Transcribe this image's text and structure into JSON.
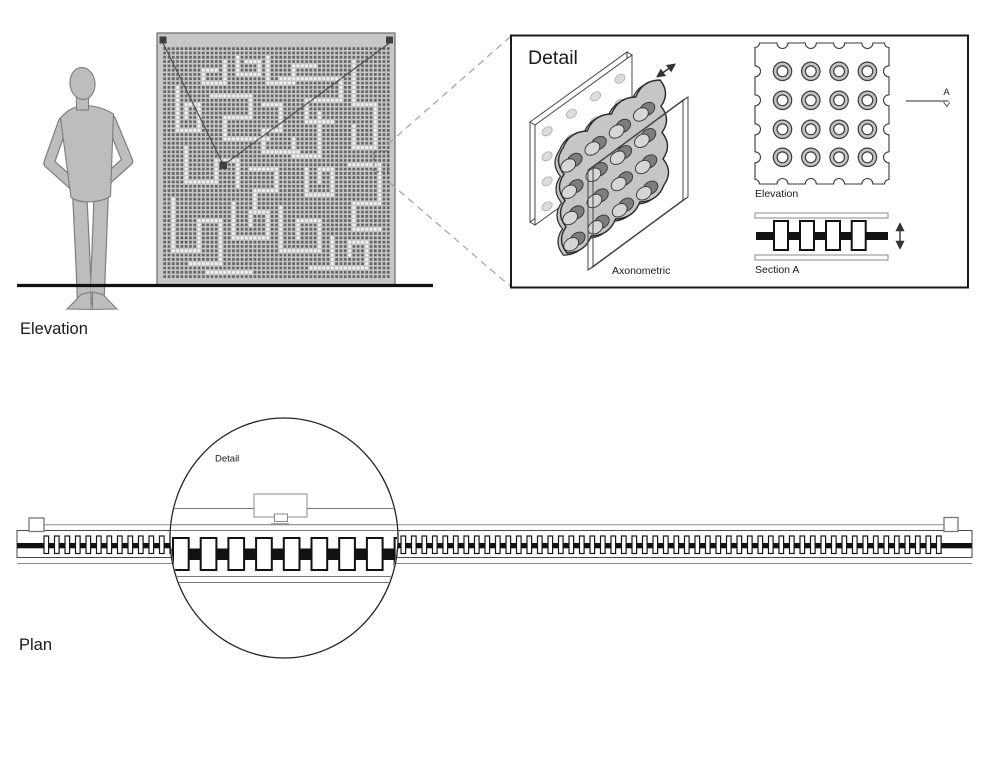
{
  "labels": {
    "elevation_view": "Elevation",
    "plan_view": "Plan",
    "detail_box_title": "Detail",
    "axonometric": "Axonometric",
    "detail_elevation": "Elevation",
    "section_a": "Section A",
    "section_marker": "A",
    "plan_detail_callout": "Detail"
  },
  "colors": {
    "ink": "#1a1a1a",
    "line_mid": "#555555",
    "line_light": "#8a8a8a",
    "dash": "#a2a2a2",
    "panel_bg": "#c7c7c7",
    "panel_dot": "#646464",
    "panel_dot_lit": "#f2f2f2",
    "silhouette": "#bdbdbd",
    "silhouette_outline": "#7d7d7d",
    "plate": "#c6c6c6",
    "peg_face": "#d6d6d6",
    "peg_dark": "#7d7d7d",
    "slab_hole": "#dcdcdc"
  },
  "panel_pattern": {
    "cols": 53,
    "rows": 54,
    "pitch": 4.3,
    "dot": 2.7,
    "origin": [
      162.5,
      46.5
    ],
    "lit_paths": [
      [
        [
          14,
          3
        ],
        [
          14,
          8
        ],
        [
          9,
          8
        ],
        [
          9,
          5
        ],
        [
          12,
          5
        ]
      ],
      [
        [
          17,
          2
        ],
        [
          17,
          6
        ],
        [
          22,
          6
        ],
        [
          22,
          3
        ],
        [
          19,
          3
        ]
      ],
      [
        [
          24,
          2
        ],
        [
          24,
          8
        ],
        [
          30,
          8
        ],
        [
          30,
          4
        ],
        [
          35,
          4
        ]
      ],
      [
        [
          3,
          9
        ],
        [
          3,
          19
        ],
        [
          8,
          19
        ],
        [
          8,
          13
        ],
        [
          5,
          13
        ],
        [
          5,
          16
        ]
      ],
      [
        [
          11,
          11
        ],
        [
          20,
          11
        ],
        [
          20,
          16
        ],
        [
          14,
          16
        ],
        [
          14,
          21
        ],
        [
          24,
          21
        ]
      ],
      [
        [
          27,
          7
        ],
        [
          41,
          7
        ],
        [
          41,
          12
        ],
        [
          33,
          12
        ],
        [
          33,
          17
        ],
        [
          39,
          17
        ]
      ],
      [
        [
          44,
          3
        ],
        [
          44,
          13
        ],
        [
          49,
          13
        ],
        [
          49,
          23
        ],
        [
          44,
          23
        ],
        [
          44,
          18
        ]
      ],
      [
        [
          23,
          13
        ],
        [
          27,
          13
        ],
        [
          27,
          19
        ],
        [
          23,
          19
        ],
        [
          23,
          24
        ],
        [
          31,
          24
        ]
      ],
      [
        [
          36,
          15
        ],
        [
          36,
          25
        ],
        [
          30,
          25
        ],
        [
          30,
          21
        ]
      ],
      [
        [
          5,
          23
        ],
        [
          5,
          31
        ],
        [
          12,
          31
        ],
        [
          12,
          26
        ],
        [
          17,
          26
        ],
        [
          17,
          32
        ]
      ],
      [
        [
          20,
          28
        ],
        [
          26,
          28
        ],
        [
          26,
          33
        ],
        [
          21,
          33
        ],
        [
          21,
          37
        ]
      ],
      [
        [
          33,
          28
        ],
        [
          33,
          34
        ],
        [
          39,
          34
        ],
        [
          39,
          28
        ],
        [
          36,
          28
        ],
        [
          36,
          31
        ]
      ],
      [
        [
          43,
          27
        ],
        [
          50,
          27
        ],
        [
          50,
          36
        ],
        [
          44,
          36
        ],
        [
          44,
          42
        ],
        [
          50,
          42
        ]
      ],
      [
        [
          2,
          35
        ],
        [
          2,
          47
        ],
        [
          8,
          47
        ],
        [
          8,
          40
        ],
        [
          13,
          40
        ],
        [
          13,
          50
        ],
        [
          6,
          50
        ]
      ],
      [
        [
          16,
          36
        ],
        [
          16,
          44
        ],
        [
          24,
          44
        ],
        [
          24,
          38
        ],
        [
          20,
          38
        ],
        [
          20,
          41
        ]
      ],
      [
        [
          27,
          37
        ],
        [
          27,
          47
        ],
        [
          36,
          47
        ],
        [
          36,
          40
        ],
        [
          31,
          40
        ],
        [
          31,
          44
        ]
      ],
      [
        [
          39,
          44
        ],
        [
          39,
          51
        ],
        [
          47,
          51
        ],
        [
          47,
          45
        ],
        [
          43,
          45
        ],
        [
          43,
          48
        ]
      ],
      [
        [
          10,
          52
        ],
        [
          20,
          52
        ]
      ],
      [
        [
          34,
          51
        ],
        [
          42,
          51
        ]
      ]
    ]
  },
  "mini_elevation": {
    "x": 755,
    "y": 43,
    "w": 134,
    "h": 141,
    "col_off": [
      27.5,
      55.8,
      84.1,
      112.4
    ],
    "row_off": [
      28.3,
      57.3,
      86.3,
      114.3
    ],
    "notch_r": 5.5,
    "corner_r": 4.5,
    "ring_r": 9.2,
    "ring_inner_r": 5.4
  },
  "section_drawing": {
    "x": 755,
    "w": 133,
    "strip_top_y": 213,
    "strip_h": 5,
    "strip_bot_y": 255,
    "bar_y": 232,
    "bar_h": 8,
    "mull_xs": [
      774,
      800,
      826,
      851.7
    ],
    "mull_w": 14,
    "mull_y": 221,
    "mull_h": 29,
    "arrow_x": 900,
    "arrow_y1": 224,
    "arrow_y2": 248
  },
  "plan_track": {
    "x0": 17,
    "x1": 972,
    "line_a_y": 524.8,
    "line_a_x0": 44,
    "line_a_x1": 944,
    "encl_top": 530.5,
    "encl_bot": 557.5,
    "line_d_y": 563.5,
    "bar_y": 543,
    "bar_h": 5.3,
    "rect_w": 4.6,
    "rect_h": 17.5,
    "rect_y": 536,
    "rect_start": 44,
    "rect_pitch": 10.5,
    "rect_count": 86
  },
  "plan_detail": {
    "cx": 284,
    "cy": 538,
    "rx": 114,
    "ry": 120,
    "lines_y": [
      508.5,
      524.8,
      530.5,
      576.5,
      582.5
    ],
    "bar_y": 548.5,
    "bar_h": 11.5,
    "rect_w": 15.7,
    "rect_h": 32,
    "rect_y": 538,
    "rect_start": 173,
    "rect_pitch": 27.7,
    "rect_count": 9,
    "box": [
      254,
      494,
      53,
      23
    ],
    "tab": [
      274.5,
      514,
      13,
      7.5
    ],
    "tab_base_y": 523.8
  },
  "axo": {
    "back_slab": [
      [
        535,
        125
      ],
      [
        632,
        55
      ],
      [
        632,
        155
      ],
      [
        535,
        225
      ]
    ],
    "back_offset": [
      -5,
      -3
    ],
    "front_slab": [
      [
        588,
        170
      ],
      [
        683,
        100
      ],
      [
        683,
        200
      ],
      [
        588,
        270
      ]
    ],
    "front_offset": [
      5,
      -3
    ],
    "plate": [
      [
        563,
        148
      ],
      [
        660,
        80
      ],
      [
        664,
        185
      ],
      [
        567,
        253
      ]
    ],
    "bump": 5,
    "peg_grid": 4,
    "hole_grid": 4
  }
}
